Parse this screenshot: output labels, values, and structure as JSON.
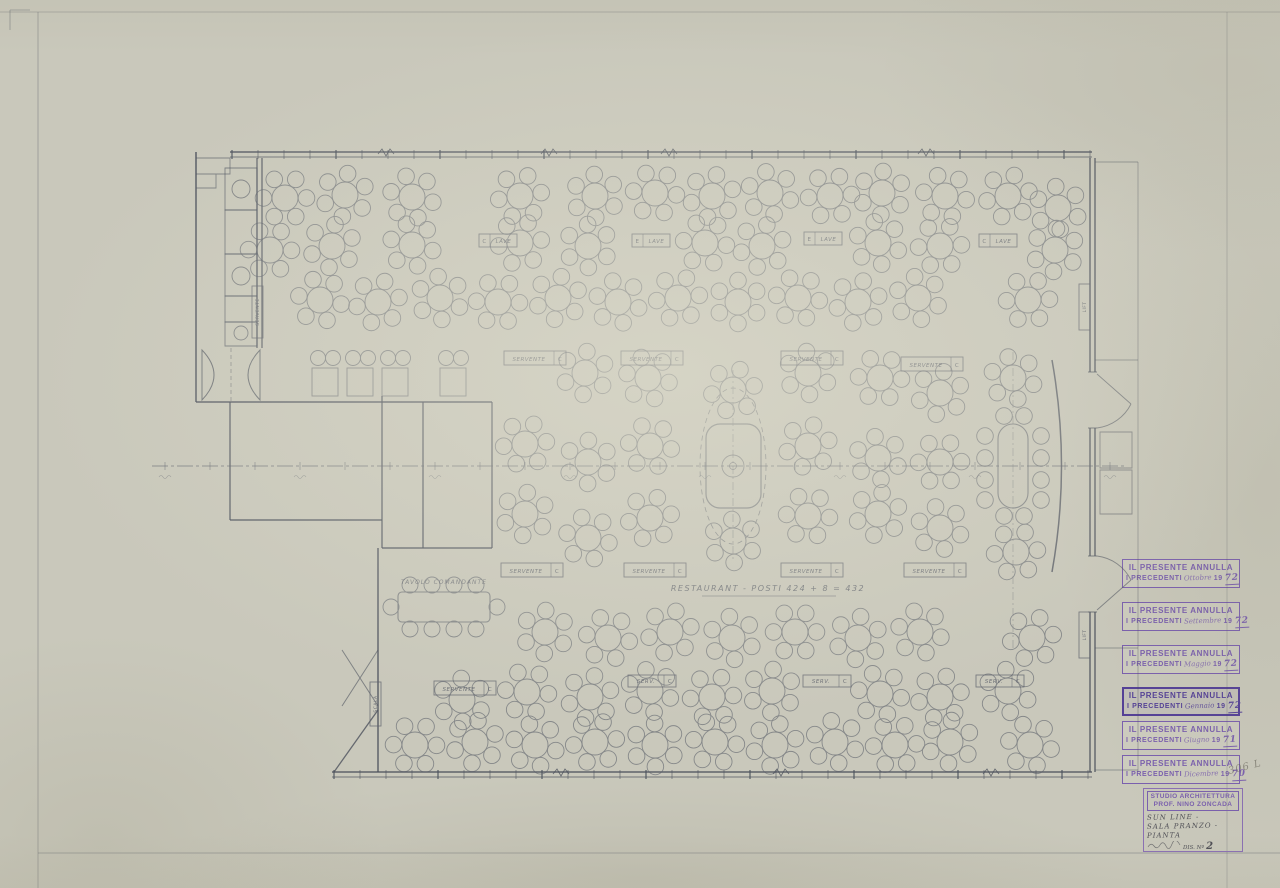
{
  "sheet": {
    "caption": "RESTAURANT  -  POSTI  424 + 8 = 432",
    "pencil_note": "306 L",
    "colors": {
      "paper": "#c9c8bb",
      "ink": "#5d616b",
      "wall": "#4c515d",
      "stamp_purple": "#7a5fae",
      "stamp_bold_purple": "#533f97",
      "pencil": "#4e4e55"
    }
  },
  "stamps": [
    {
      "y": 559,
      "line1": "IL PRESENTE ANNULLA",
      "prefix": "I PRECEDENTI",
      "month": "Ottobre",
      "year_printed": "19",
      "year_hand": "72",
      "bold": false
    },
    {
      "y": 602,
      "line1": "IL PRESENTE ANNULLA",
      "prefix": "I PRECEDENTI",
      "month": "Settembre",
      "year_printed": "19",
      "year_hand": "72",
      "bold": false
    },
    {
      "y": 645,
      "line1": "IL PRESENTE ANNULLA",
      "prefix": "I PRECEDENTI",
      "month": "Maggio",
      "year_printed": "19",
      "year_hand": "72",
      "bold": false
    },
    {
      "y": 687,
      "line1": "IL PRESENTE ANNULLA",
      "prefix": "I PRECEDENTI",
      "month": "Gennaio",
      "year_printed": "19",
      "year_hand": "72",
      "bold": true
    },
    {
      "y": 721,
      "line1": "IL PRESENTE ANNULLA",
      "prefix": "I PRECEDENTI",
      "month": "Giugno",
      "year_printed": "19",
      "year_hand": "71",
      "bold": false
    },
    {
      "y": 755,
      "line1": "IL PRESENTE ANNULLA",
      "prefix": "I PRECEDENTI",
      "month": "Dicembre",
      "year_printed": "19",
      "year_hand": "70",
      "bold": false
    }
  ],
  "title_block": {
    "studio_line1": "STUDIO ARCHITETTURA",
    "studio_line2": "PROF. NINO ZONCADA",
    "project": "SUN LINE -",
    "subject1": "SALA PRANZO -",
    "subject2": "PIANTA",
    "drawing_label": "DIS. Nº",
    "drawing_no": "2"
  },
  "plan": {
    "captain_table_label": {
      "x": 444,
      "y": 584,
      "text": "TAVOLO COMANDANTE"
    },
    "station_boxes": [
      {
        "x": 504,
        "y": 351,
        "w": 62,
        "h": 14,
        "text": "SERVENTE",
        "cell": "C"
      },
      {
        "x": 621,
        "y": 351,
        "w": 62,
        "h": 14,
        "text": "SERVENTE",
        "cell": "C"
      },
      {
        "x": 781,
        "y": 351,
        "w": 62,
        "h": 14,
        "text": "SERVENTE",
        "cell": "C"
      },
      {
        "x": 901,
        "y": 357,
        "w": 62,
        "h": 14,
        "text": "SERVENTE",
        "cell": "C"
      },
      {
        "x": 501,
        "y": 563,
        "w": 62,
        "h": 14,
        "text": "SERVENTE",
        "cell": "C"
      },
      {
        "x": 624,
        "y": 563,
        "w": 62,
        "h": 14,
        "text": "SERVENTE",
        "cell": "C"
      },
      {
        "x": 781,
        "y": 563,
        "w": 62,
        "h": 14,
        "text": "SERVENTE",
        "cell": "C"
      },
      {
        "x": 904,
        "y": 563,
        "w": 62,
        "h": 14,
        "text": "SERVENTE",
        "cell": "C"
      },
      {
        "x": 434,
        "y": 681,
        "w": 62,
        "h": 14,
        "text": "SERVENTE",
        "cell": "C"
      },
      {
        "x": 628,
        "y": 675,
        "w": 48,
        "h": 12,
        "text": "SERV.",
        "cell": "C"
      },
      {
        "x": 803,
        "y": 675,
        "w": 48,
        "h": 12,
        "text": "SERV.",
        "cell": "C"
      },
      {
        "x": 976,
        "y": 675,
        "w": 48,
        "h": 12,
        "text": "SERV.",
        "cell": "C"
      }
    ],
    "lave_boxes": [
      {
        "x": 479,
        "y": 234,
        "w": 38,
        "h": 13,
        "cell": "C",
        "text": "LAVE"
      },
      {
        "x": 632,
        "y": 234,
        "w": 38,
        "h": 13,
        "cell": "E",
        "text": "LAVE"
      },
      {
        "x": 804,
        "y": 232,
        "w": 38,
        "h": 13,
        "cell": "E",
        "text": "LAVE"
      },
      {
        "x": 979,
        "y": 234,
        "w": 38,
        "h": 13,
        "cell": "C",
        "text": "LAVE"
      }
    ],
    "vertical_boxes": [
      {
        "x": 252,
        "y": 286,
        "w": 11,
        "h": 52,
        "text": "SERVENTE"
      },
      {
        "x": 1079,
        "y": 284,
        "w": 11,
        "h": 46,
        "text": "LIFT"
      },
      {
        "x": 1079,
        "y": 612,
        "w": 11,
        "h": 46,
        "text": "LIFT"
      },
      {
        "x": 370,
        "y": 682,
        "w": 11,
        "h": 44,
        "text": "SCALA"
      }
    ],
    "round_tables": [
      [
        285,
        198
      ],
      [
        345,
        195
      ],
      [
        412,
        197
      ],
      [
        520,
        196
      ],
      [
        595,
        196
      ],
      [
        655,
        193
      ],
      [
        712,
        196
      ],
      [
        770,
        193
      ],
      [
        830,
        196
      ],
      [
        882,
        193
      ],
      [
        945,
        196
      ],
      [
        1008,
        196
      ],
      [
        1058,
        208
      ],
      [
        270,
        250
      ],
      [
        332,
        246
      ],
      [
        412,
        245
      ],
      [
        520,
        243
      ],
      [
        588,
        246
      ],
      [
        705,
        243
      ],
      [
        762,
        246
      ],
      [
        878,
        243
      ],
      [
        940,
        246
      ],
      [
        1055,
        250
      ],
      [
        320,
        300
      ],
      [
        378,
        302
      ],
      [
        440,
        298
      ],
      [
        498,
        302
      ],
      [
        558,
        298
      ],
      [
        618,
        302
      ],
      [
        678,
        298
      ],
      [
        738,
        302
      ],
      [
        798,
        298
      ],
      [
        858,
        302
      ],
      [
        918,
        298
      ],
      [
        1028,
        300
      ],
      [
        585,
        373
      ],
      [
        648,
        378
      ],
      [
        733,
        390
      ],
      [
        808,
        373
      ],
      [
        880,
        378
      ],
      [
        940,
        393
      ],
      [
        1013,
        378
      ],
      [
        525,
        444
      ],
      [
        588,
        462
      ],
      [
        650,
        446
      ],
      [
        808,
        446
      ],
      [
        878,
        458
      ],
      [
        940,
        462
      ],
      [
        525,
        514
      ],
      [
        588,
        538
      ],
      [
        650,
        518
      ],
      [
        733,
        541
      ],
      [
        808,
        516
      ],
      [
        878,
        514
      ],
      [
        940,
        528
      ],
      [
        1016,
        552
      ],
      [
        545,
        632
      ],
      [
        608,
        638
      ],
      [
        670,
        632
      ],
      [
        732,
        638
      ],
      [
        795,
        632
      ],
      [
        858,
        638
      ],
      [
        920,
        632
      ],
      [
        1032,
        638
      ],
      [
        462,
        700
      ],
      [
        527,
        692
      ],
      [
        590,
        697
      ],
      [
        650,
        691
      ],
      [
        712,
        697
      ],
      [
        772,
        691
      ],
      [
        880,
        694
      ],
      [
        940,
        697
      ],
      [
        1008,
        691
      ],
      [
        415,
        745
      ],
      [
        475,
        742
      ],
      [
        535,
        745
      ],
      [
        595,
        742
      ],
      [
        655,
        745
      ],
      [
        715,
        742
      ],
      [
        775,
        745
      ],
      [
        835,
        742
      ],
      [
        895,
        745
      ],
      [
        950,
        742
      ],
      [
        1030,
        745
      ]
    ],
    "rect_tables": [
      [
        312,
        368
      ],
      [
        347,
        368
      ],
      [
        382,
        368
      ],
      [
        440,
        368
      ]
    ],
    "rect_chairs": [
      [
        318,
        358
      ],
      [
        333,
        358
      ],
      [
        353,
        358
      ],
      [
        368,
        358
      ],
      [
        388,
        358
      ],
      [
        403,
        358
      ],
      [
        446,
        358
      ],
      [
        461,
        358
      ]
    ]
  }
}
